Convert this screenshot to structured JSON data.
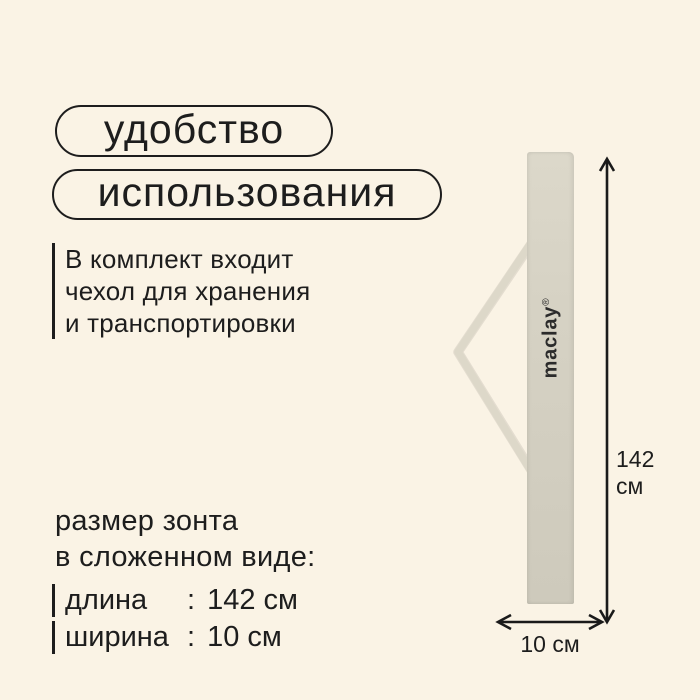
{
  "colors": {
    "background": "#faf3e5",
    "text": "#1d1d1d",
    "arrow": "#1a1a1a",
    "case_light": "#dcd8ca",
    "case_mid": "#d6d2c4",
    "case_dark": "#cecabc",
    "strap": "#ddd8c9",
    "logo": "#2b2b2b"
  },
  "badges": {
    "line1": "удобство",
    "line2": "использования"
  },
  "description": {
    "lines": [
      "В комплект входит",
      "чехол для хранения",
      "и транспортировки"
    ]
  },
  "size_section": {
    "heading_line1": "размер зонта",
    "heading_line2": "в сложенном виде:",
    "colon": ":",
    "specs": [
      {
        "label": "длина",
        "value": "142 см"
      },
      {
        "label": "ширина",
        "value": "10 см"
      }
    ]
  },
  "product": {
    "brand": "maclay",
    "reg_mark": "®"
  },
  "dimensions": {
    "height_value": "142",
    "height_unit": "см",
    "width_label": "10 см"
  }
}
